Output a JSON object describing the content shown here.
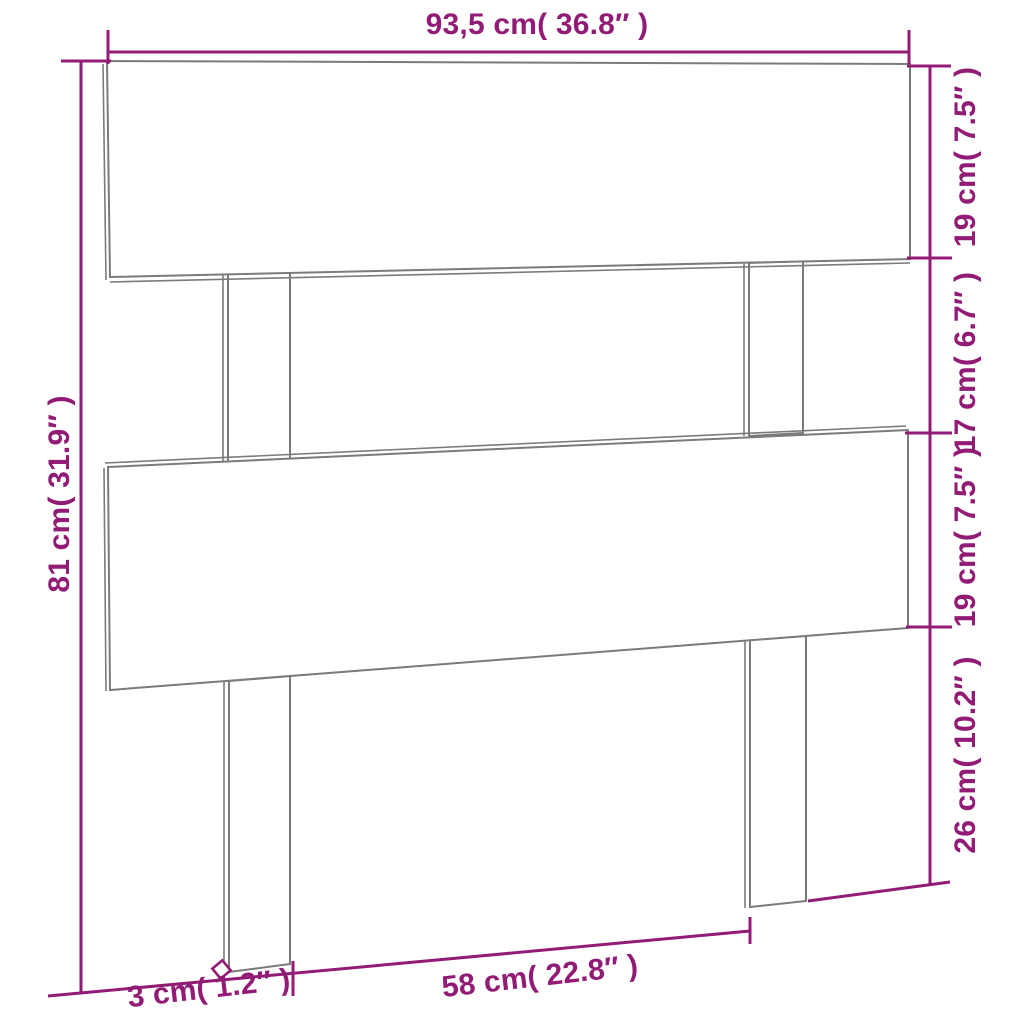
{
  "diagram": {
    "type": "product-dimension-diagram",
    "subject": "headboard",
    "colors": {
      "dimension_accent": "#921b76",
      "product_outline": "#7b7b7b",
      "background": "#ffffff"
    },
    "dimension_labels": {
      "overall_width": "93,5 cm( 36.8″ )",
      "overall_height": "81 cm( 31.9″ )",
      "top_board_height": "19 cm( 7.5″ )",
      "board_gap_height": "17 cm( 6.7″ )",
      "lower_board_height": "19 cm( 7.5″ )",
      "leg_height": "26 cm( 10.2″ )",
      "legs_inner_spacing": "58 cm( 22.8″ )",
      "leg_thickness": "3 cm( 1.2″ )"
    },
    "icons": {
      "thickness_marker": "diamond-outline-icon"
    }
  }
}
